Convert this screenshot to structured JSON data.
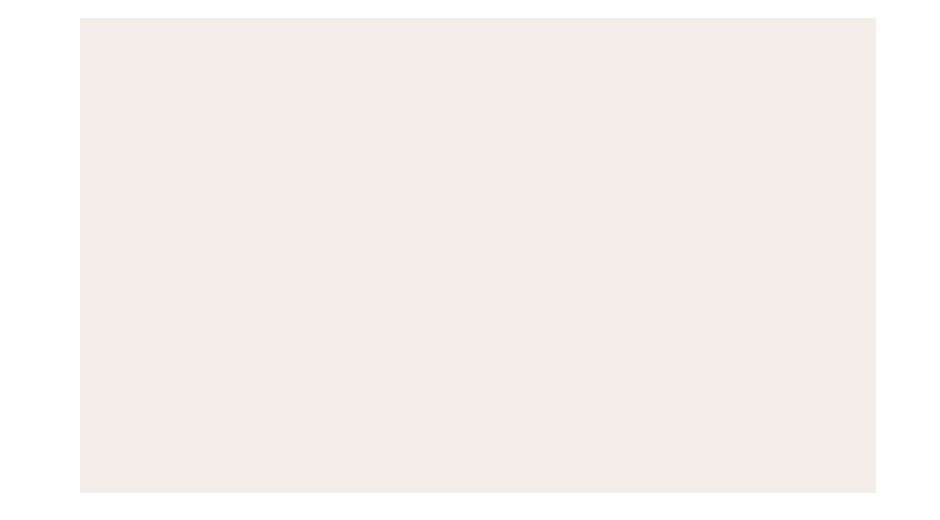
{
  "canvas": {
    "background_color": "#ffffff",
    "panel_color": "#f2ede6",
    "panel": {
      "left_px": 80,
      "top_px": 18,
      "width_px": 796,
      "height_px": 475
    }
  }
}
